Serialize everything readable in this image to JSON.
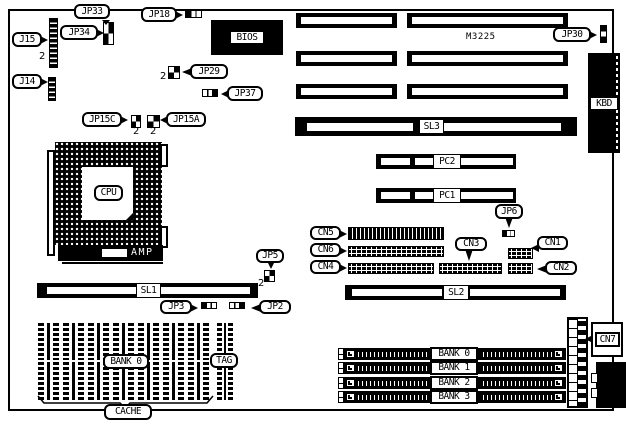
{
  "diagram": {
    "description": "Motherboard layout diagram",
    "chipset_label": "M3225",
    "amp_label": "AMP",
    "pin2_mark": "2"
  },
  "labels": {
    "jp33": "JP33",
    "jp34": "JP34",
    "j15": "J15",
    "j14": "J14",
    "jp18": "JP18",
    "jp29": "JP29",
    "jp37": "JP37",
    "jp15c": "JP15C",
    "jp15a": "JP15A",
    "jp30": "JP30",
    "jp6": "JP6",
    "jp5": "JP5",
    "jp3": "JP3",
    "jp2": "JP2",
    "cn1": "CN1",
    "cn2": "CN2",
    "cn3": "CN3",
    "cn4": "CN4",
    "cn5": "CN5",
    "cn6": "CN6",
    "cn7": "CN7",
    "bios": "BIOS",
    "cpu": "CPU",
    "kbd": "KBD",
    "sl1": "SL1",
    "sl2": "SL2",
    "sl3": "SL3",
    "pc1": "PC1",
    "pc2": "PC2",
    "cache": "CACHE",
    "tag": "TAG",
    "cache_bank": "BANK 0"
  },
  "memory_banks": [
    "BANK 0",
    "BANK 1",
    "BANK 2",
    "BANK 3"
  ],
  "colors": {
    "ink": "#000000",
    "paper": "#ffffff"
  }
}
